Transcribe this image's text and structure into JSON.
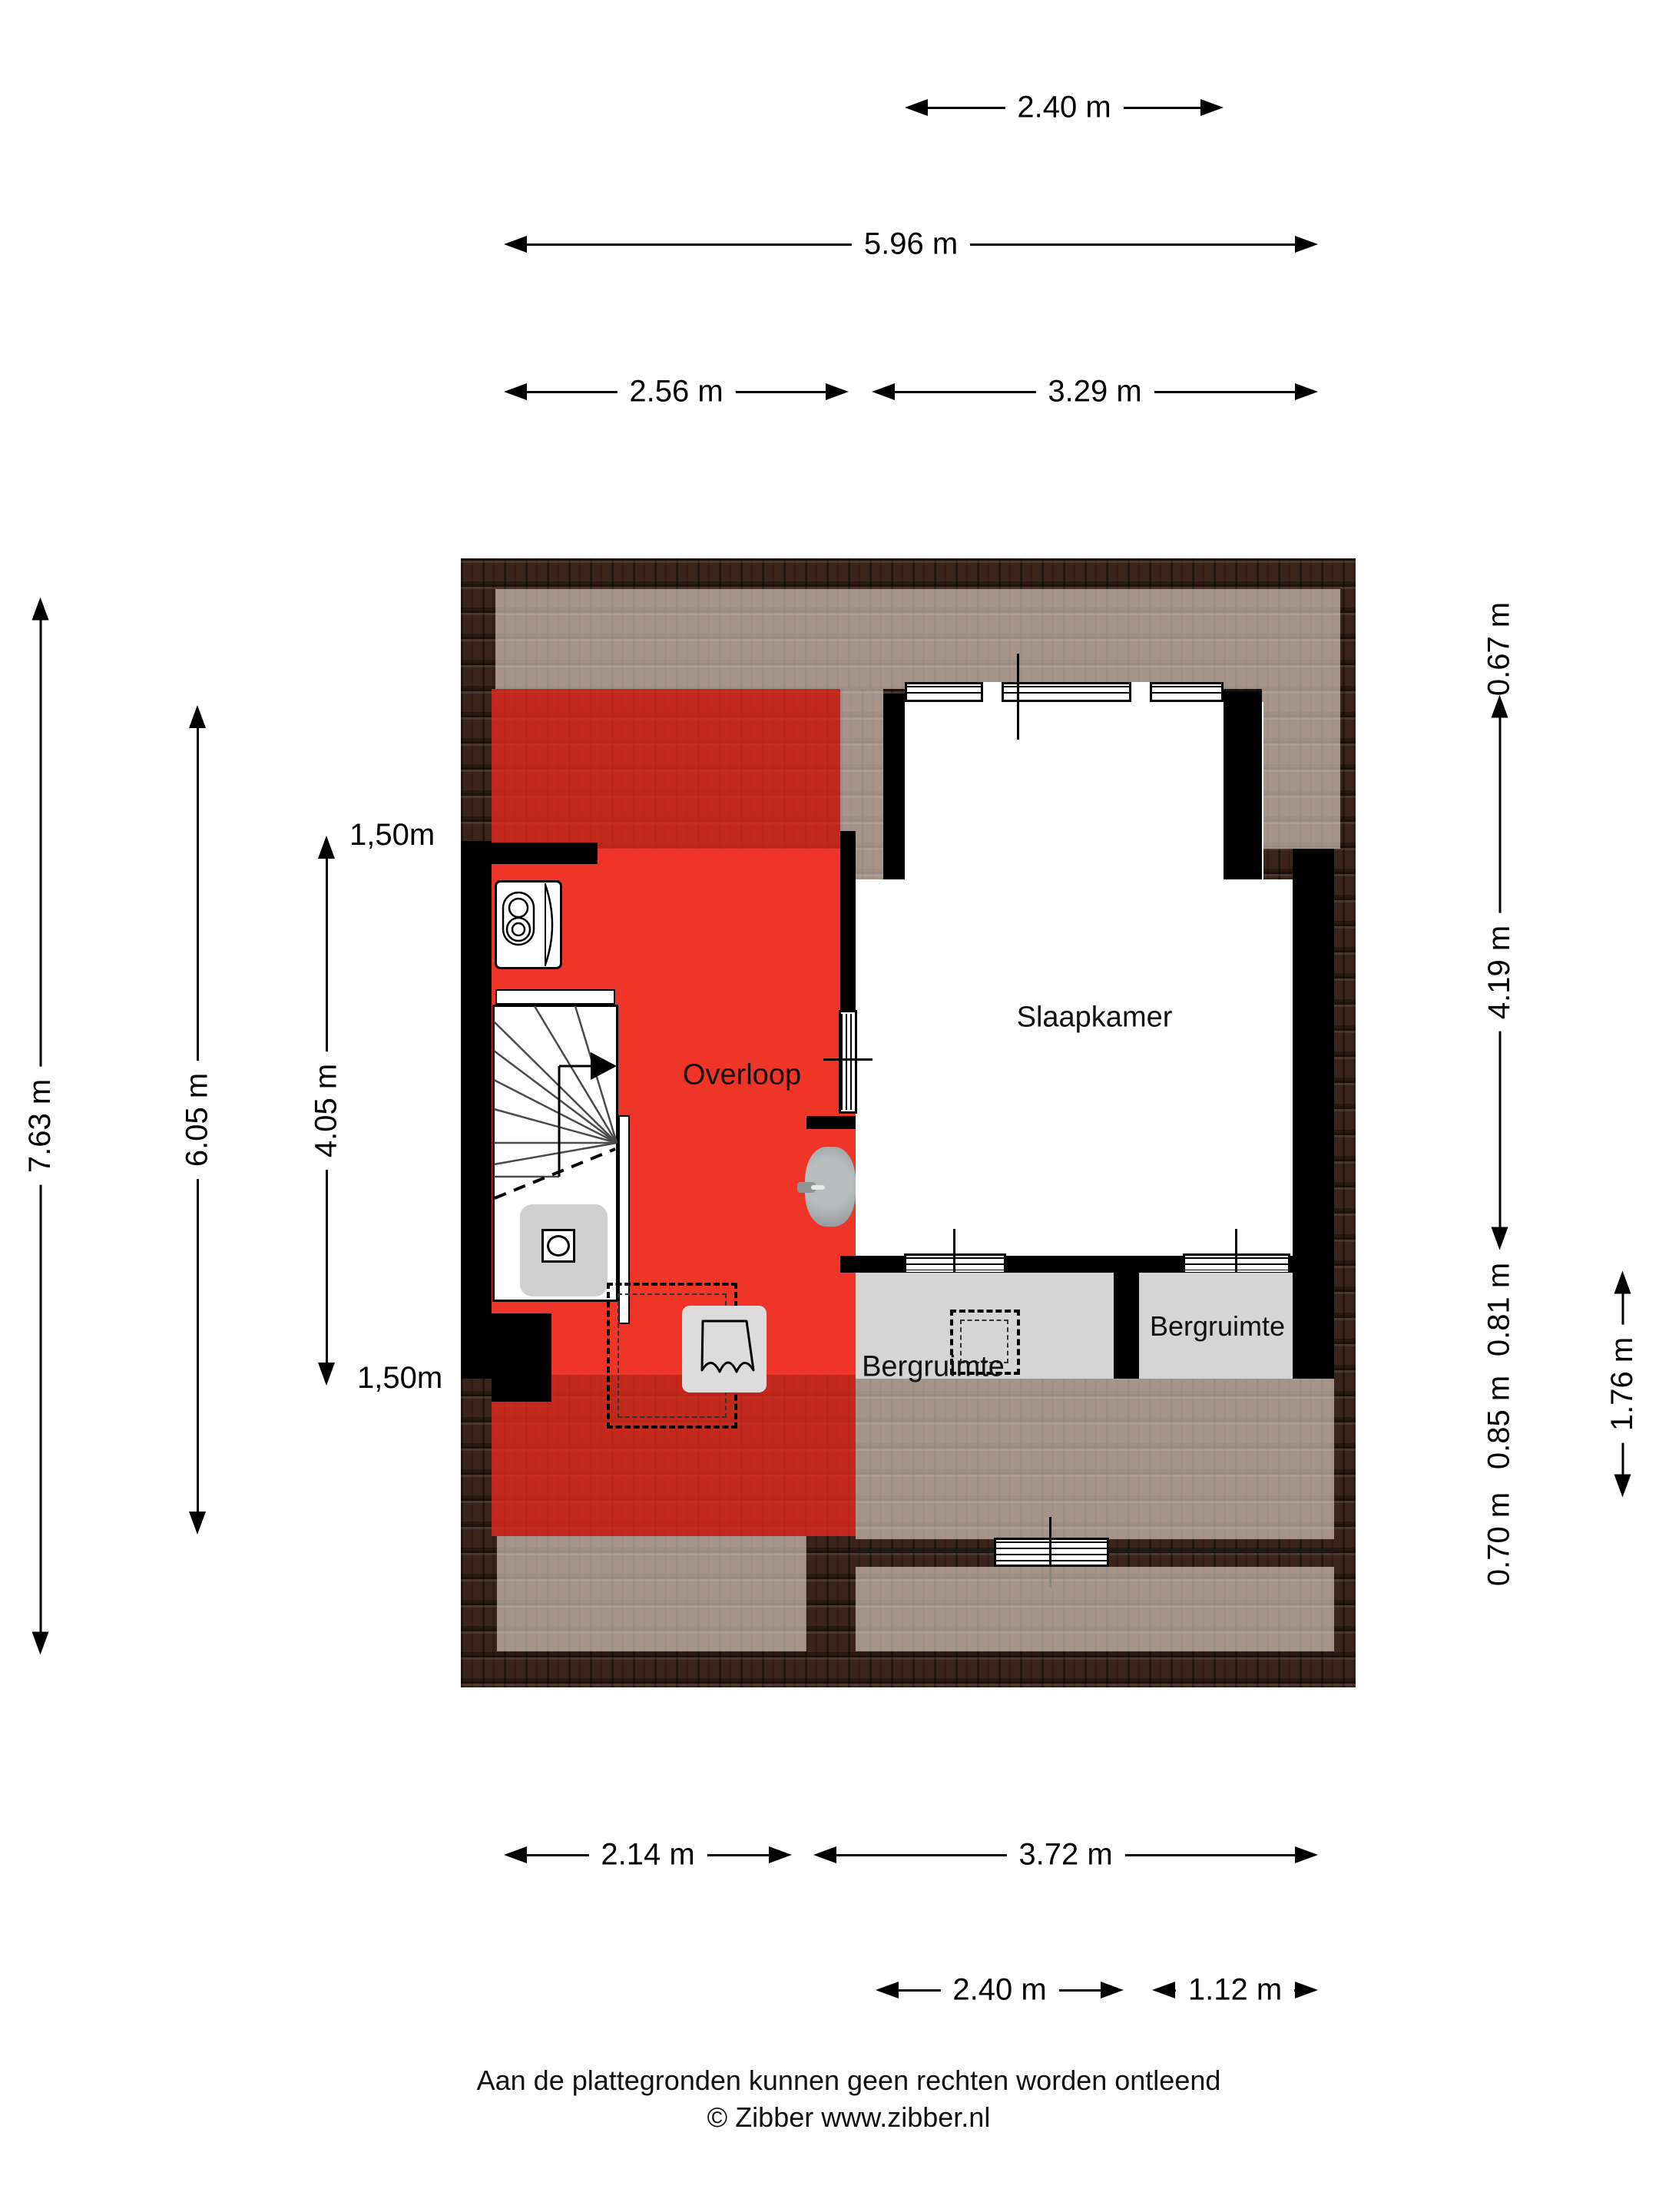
{
  "rooms": {
    "slaapkamer": "Slaapkamer",
    "overloop": "Overloop",
    "bergruimte_left": "Bergruimte",
    "bergruimte_right": "Bergruimte"
  },
  "dims": {
    "top": {
      "window": "2.40 m",
      "total": "5.96 m",
      "left_section": "2.56 m",
      "right_section": "3.29 m"
    },
    "left": {
      "total": "7.63 m",
      "inner": "6.05 m",
      "headroom": "4.05 m",
      "clearance_top": "1,50m",
      "clearance_bottom": "1,50m"
    },
    "right": {
      "eave": "0.67 m",
      "bedroom": "4.19 m",
      "seg_a": "0.81 m",
      "seg_b": "0.85 m",
      "seg_c": "0.70 m",
      "storage": "1.76 m"
    },
    "bottom": {
      "left_section": "2.14 m",
      "right_section": "3.72 m",
      "window": "2.40 m",
      "edge": "1.12 m"
    }
  },
  "footer": {
    "disclaimer": "Aan de plattegronden kunnen geen rechten worden ontleend",
    "credit": "© Zibber www.zibber.nl"
  },
  "icons": {
    "washing_machine": "washing-machine-icon",
    "toilet": "toilet-icon",
    "sink": "sink-icon",
    "stairs": "stairs-icon",
    "shower_drain": "shower-drain-icon"
  },
  "colors": {
    "accent_red": "#EE3527",
    "roof_dark": "#3A241C",
    "roof_light": "#A68D80",
    "storage_gray": "#D5D5D5",
    "wall_black": "#000000",
    "floor_white": "#FFFFFF"
  }
}
